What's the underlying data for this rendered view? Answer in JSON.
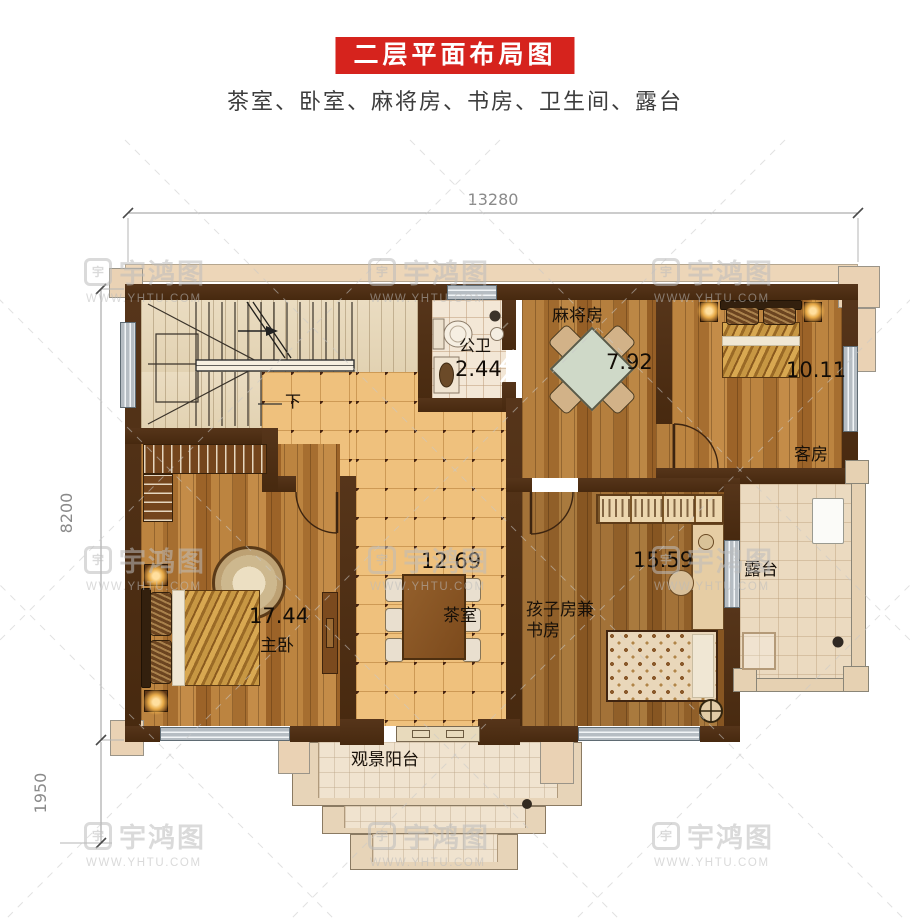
{
  "header": {
    "title": "二层平面布局图",
    "subtitle": "茶室、卧室、麻将房、书房、卫生间、露台"
  },
  "dimensions": {
    "top": "13280",
    "left": "8200",
    "bottom_left": "1950"
  },
  "rooms": {
    "bathroom": {
      "name": "公卫",
      "area": "2.44"
    },
    "mahjong": {
      "name": "麻将房",
      "area": "7.92"
    },
    "guest": {
      "name": "客房",
      "area": "10.11"
    },
    "tea": {
      "name": "茶室",
      "area": "12.69"
    },
    "master": {
      "name": "主卧",
      "area": "17.44"
    },
    "kids": {
      "name_line1": "孩子房兼",
      "name_line2": "书房",
      "area": "15.59"
    },
    "terrace": {
      "name": "露台"
    },
    "balcony": {
      "name": "观景阳台"
    },
    "stairs": {
      "down_label": "下"
    }
  },
  "watermark": {
    "brand": "宇鸿图",
    "url": "WWW.YHTU.COM",
    "logo_char": "宇"
  },
  "colors": {
    "banner_red": "#d6231d",
    "wall_brown": "#4e2f15",
    "wood_floor": "#ac7434",
    "tile_floor": "#efc17d",
    "dimension_gray": "#8a8a8a"
  }
}
